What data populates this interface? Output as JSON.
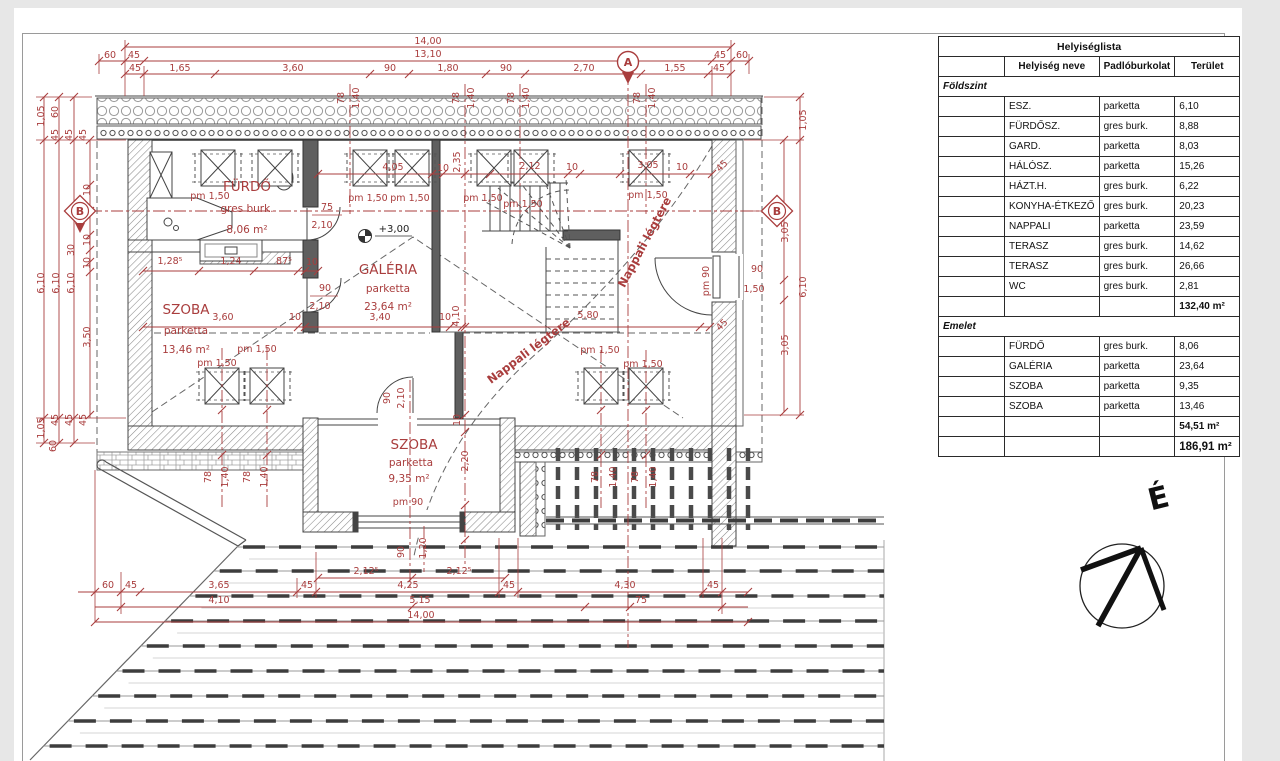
{
  "page": {
    "background": "#e7e7e7",
    "sheet_color": "#ffffff",
    "accent_red": "#a93d3d",
    "line_color": "#444444"
  },
  "plan": {
    "rooms": [
      {
        "name": "FÜRDŐ",
        "floor": "gres burk.",
        "area": "8,06 m²"
      },
      {
        "name": "GALÉRIA",
        "floor": "parketta",
        "area": "23,64 m²"
      },
      {
        "name": "SZOBA",
        "floor": "parketta",
        "area": "13,46 m²"
      },
      {
        "name": "SZOBA",
        "floor": "parketta",
        "area": "9,35 m²"
      }
    ],
    "section_markers": [
      "A",
      "B",
      "B"
    ],
    "level_marker": "+3,00",
    "north_label": "É",
    "labels": [
      {
        "t": "14,00",
        "x": 428,
        "y": 44
      },
      {
        "t": "60",
        "x": 110,
        "y": 58
      },
      {
        "t": "45",
        "x": 134,
        "y": 58
      },
      {
        "t": "13,10",
        "x": 428,
        "y": 57
      },
      {
        "t": "45",
        "x": 720,
        "y": 58
      },
      {
        "t": "60",
        "x": 742,
        "y": 58
      },
      {
        "t": "45",
        "x": 135,
        "y": 71
      },
      {
        "t": "1,65",
        "x": 180,
        "y": 71
      },
      {
        "t": "3,60",
        "x": 293,
        "y": 71
      },
      {
        "t": "90",
        "x": 390,
        "y": 71
      },
      {
        "t": "1,80",
        "x": 448,
        "y": 71
      },
      {
        "t": "90",
        "x": 506,
        "y": 71
      },
      {
        "t": "2,70",
        "x": 584,
        "y": 71
      },
      {
        "t": "1,55",
        "x": 675,
        "y": 71
      },
      {
        "t": "45",
        "x": 719,
        "y": 71
      },
      {
        "t": "78",
        "x": 344,
        "y": 98,
        "r": -90
      },
      {
        "t": "1,40",
        "x": 359,
        "y": 98,
        "r": -90
      },
      {
        "t": "78",
        "x": 459,
        "y": 98,
        "r": -90
      },
      {
        "t": "1,40",
        "x": 474,
        "y": 98,
        "r": -90
      },
      {
        "t": "78",
        "x": 514,
        "y": 98,
        "r": -90
      },
      {
        "t": "1,40",
        "x": 529,
        "y": 98,
        "r": -90
      },
      {
        "t": "78",
        "x": 640,
        "y": 98,
        "r": -90
      },
      {
        "t": "1,40",
        "x": 655,
        "y": 98,
        "r": -90
      },
      {
        "t": "1,05",
        "x": 44,
        "y": 116,
        "r": -90
      },
      {
        "t": "60",
        "x": 58,
        "y": 112,
        "r": -90
      },
      {
        "t": "45",
        "x": 58,
        "y": 135,
        "r": -90
      },
      {
        "t": "45",
        "x": 72,
        "y": 135,
        "r": -90
      },
      {
        "t": "45",
        "x": 86,
        "y": 135,
        "r": -90
      },
      {
        "t": "6,10",
        "x": 44,
        "y": 283,
        "r": -90
      },
      {
        "t": "6,10",
        "x": 59,
        "y": 283,
        "r": -90
      },
      {
        "t": "6,10",
        "x": 74,
        "y": 283,
        "r": -90
      },
      {
        "t": "10",
        "x": 90,
        "y": 190,
        "r": -90
      },
      {
        "t": "10",
        "x": 90,
        "y": 240,
        "r": -90
      },
      {
        "t": "30",
        "x": 74,
        "y": 250,
        "r": -90
      },
      {
        "t": "10",
        "x": 90,
        "y": 263,
        "r": -90
      },
      {
        "t": "3,50",
        "x": 90,
        "y": 337,
        "r": -90
      },
      {
        "t": "45",
        "x": 58,
        "y": 420,
        "r": -90
      },
      {
        "t": "45",
        "x": 72,
        "y": 420,
        "r": -90
      },
      {
        "t": "45",
        "x": 86,
        "y": 420,
        "r": -90
      },
      {
        "t": "1,05",
        "x": 44,
        "y": 428,
        "r": -90
      },
      {
        "t": "60",
        "x": 56,
        "y": 446,
        "r": -90
      },
      {
        "t": "1,05",
        "x": 806,
        "y": 120,
        "r": -90
      },
      {
        "t": "3,05",
        "x": 788,
        "y": 232,
        "r": -90
      },
      {
        "t": "6,10",
        "x": 806,
        "y": 287,
        "r": -90
      },
      {
        "t": "3,05",
        "x": 788,
        "y": 345,
        "r": -90
      },
      {
        "t": "45",
        "x": 724,
        "y": 168,
        "r": -45
      },
      {
        "t": "45",
        "x": 724,
        "y": 327,
        "r": -45
      },
      {
        "t": "pm 90",
        "x": 709,
        "y": 281,
        "r": -90
      },
      {
        "t": "90",
        "x": 757,
        "y": 272
      },
      {
        "t": "1,50",
        "x": 754,
        "y": 292
      },
      {
        "t": "2,12⁵",
        "x": 366,
        "y": 574
      },
      {
        "t": "2,12⁵",
        "x": 459,
        "y": 574
      },
      {
        "t": "60",
        "x": 108,
        "y": 588
      },
      {
        "t": "45",
        "x": 131,
        "y": 588
      },
      {
        "t": "3,65",
        "x": 219,
        "y": 588
      },
      {
        "t": "45",
        "x": 307,
        "y": 588
      },
      {
        "t": "4,25",
        "x": 408,
        "y": 588
      },
      {
        "t": "45",
        "x": 509,
        "y": 588
      },
      {
        "t": "4,30",
        "x": 625,
        "y": 588
      },
      {
        "t": "45",
        "x": 713,
        "y": 588
      },
      {
        "t": "4,10",
        "x": 219,
        "y": 603
      },
      {
        "t": "5,15",
        "x": 420,
        "y": 603
      },
      {
        "t": "75",
        "x": 641,
        "y": 603
      },
      {
        "t": "14,00",
        "x": 421,
        "y": 618
      },
      {
        "t": "90",
        "x": 404,
        "y": 552,
        "r": -90
      },
      {
        "t": "1,20",
        "x": 426,
        "y": 548,
        "r": -90
      },
      {
        "t": "78",
        "x": 211,
        "y": 477,
        "r": -90
      },
      {
        "t": "1,40",
        "x": 228,
        "y": 477,
        "r": -90
      },
      {
        "t": "78",
        "x": 250,
        "y": 477,
        "r": -90
      },
      {
        "t": "1,40",
        "x": 267,
        "y": 477,
        "r": -90
      },
      {
        "t": "78",
        "x": 598,
        "y": 477,
        "r": -90
      },
      {
        "t": "1,40",
        "x": 616,
        "y": 477,
        "r": -90
      },
      {
        "t": "78",
        "x": 638,
        "y": 477,
        "r": -90
      },
      {
        "t": "1,40",
        "x": 656,
        "y": 477,
        "r": -90
      },
      {
        "t": "4,05",
        "x": 393,
        "y": 170
      },
      {
        "t": "10",
        "x": 443,
        "y": 171
      },
      {
        "t": "2,12",
        "x": 530,
        "y": 169
      },
      {
        "t": "10",
        "x": 572,
        "y": 170
      },
      {
        "t": "3,05",
        "x": 648,
        "y": 168
      },
      {
        "t": "10",
        "x": 682,
        "y": 170
      },
      {
        "t": "2,35",
        "x": 460,
        "y": 162,
        "r": -90
      },
      {
        "t": "1,28⁵",
        "x": 170,
        "y": 264
      },
      {
        "t": "1,24",
        "x": 231,
        "y": 264
      },
      {
        "t": "87⁵",
        "x": 284,
        "y": 264
      },
      {
        "t": "10",
        "x": 312,
        "y": 265
      },
      {
        "t": "3,60",
        "x": 223,
        "y": 320
      },
      {
        "t": "10",
        "x": 295,
        "y": 320
      },
      {
        "t": "3,40",
        "x": 380,
        "y": 320
      },
      {
        "t": "10",
        "x": 445,
        "y": 320
      },
      {
        "t": "5,80",
        "x": 588,
        "y": 318
      },
      {
        "t": "4,10",
        "x": 459,
        "y": 316,
        "r": -90
      },
      {
        "t": "10",
        "x": 460,
        "y": 420,
        "r": -90
      },
      {
        "t": "2,20",
        "x": 468,
        "y": 461,
        "r": -90
      },
      {
        "t": "90",
        "x": 390,
        "y": 398,
        "r": -90
      },
      {
        "t": "2,10",
        "x": 404,
        "y": 398,
        "r": -90
      },
      {
        "t": "75",
        "x": 327,
        "y": 210
      },
      {
        "t": "2,10",
        "x": 322,
        "y": 228
      },
      {
        "t": "90",
        "x": 325,
        "y": 291
      },
      {
        "t": "2,10",
        "x": 320,
        "y": 309
      },
      {
        "t": "pm 1,50",
        "x": 210,
        "y": 199
      },
      {
        "t": "pm 1,50",
        "x": 368,
        "y": 201
      },
      {
        "t": "pm 1,50",
        "x": 410,
        "y": 201
      },
      {
        "t": "pm 1,50",
        "x": 483,
        "y": 201
      },
      {
        "t": "pm 1,50",
        "x": 523,
        "y": 207
      },
      {
        "t": "pm 1,50",
        "x": 648,
        "y": 198
      },
      {
        "t": "pm 1,50",
        "x": 257,
        "y": 352
      },
      {
        "t": "pm 1,50",
        "x": 217,
        "y": 366
      },
      {
        "t": "pm 1,50",
        "x": 600,
        "y": 353
      },
      {
        "t": "pm 1,50",
        "x": 643,
        "y": 367
      },
      {
        "t": "pm 90",
        "x": 408,
        "y": 505
      },
      {
        "t": "FÜRDŐ",
        "x": 247,
        "y": 191,
        "c": "room"
      },
      {
        "t": "gres burk.",
        "x": 247,
        "y": 212,
        "c": "sub"
      },
      {
        "t": "8,06 m²",
        "x": 247,
        "y": 233,
        "c": "sub"
      },
      {
        "t": "GALÉRIA",
        "x": 388,
        "y": 274,
        "c": "room"
      },
      {
        "t": "parketta",
        "x": 388,
        "y": 292,
        "c": "sub"
      },
      {
        "t": "23,64 m²",
        "x": 388,
        "y": 310,
        "c": "sub"
      },
      {
        "t": "SZOBA",
        "x": 186,
        "y": 314,
        "c": "room"
      },
      {
        "t": "parketta",
        "x": 186,
        "y": 334,
        "c": "sub"
      },
      {
        "t": "13,46 m²",
        "x": 186,
        "y": 353,
        "c": "sub"
      },
      {
        "t": "SZOBA",
        "x": 414,
        "y": 449,
        "c": "room"
      },
      {
        "t": "parketta",
        "x": 411,
        "y": 466,
        "c": "sub"
      },
      {
        "t": "9,35 m²",
        "x": 409,
        "y": 482,
        "c": "sub"
      },
      {
        "t": "Nappali légtere",
        "x": 648,
        "y": 244,
        "r": -62,
        "c": "ann"
      },
      {
        "t": "Nappali légtere",
        "x": 531,
        "y": 354,
        "r": -37,
        "c": "ann"
      },
      {
        "t": "+3,00",
        "x": 394,
        "y": 232,
        "c": "lvl"
      },
      {
        "t": "A",
        "x": 628,
        "y": 66,
        "c": "mk"
      },
      {
        "t": "B",
        "x": 80,
        "y": 215,
        "c": "mk"
      },
      {
        "t": "B",
        "x": 777,
        "y": 215,
        "c": "mk"
      },
      {
        "t": "É",
        "x": 1161,
        "y": 508,
        "r": -14,
        "c": "north"
      }
    ]
  },
  "room_table": {
    "title": "Helyiséglista",
    "headers": [
      "",
      "Helyiség neve",
      "Padlóburkolat",
      "Terület"
    ],
    "sections": [
      {
        "name": "Földszint",
        "rows": [
          [
            "ESZ.",
            "parketta",
            "6,10"
          ],
          [
            "FÜRDŐSZ.",
            "gres burk.",
            "8,88"
          ],
          [
            "GARD.",
            "parketta",
            "8,03"
          ],
          [
            "HÁLÓSZ.",
            "parketta",
            "15,26"
          ],
          [
            "HÁZT.H.",
            "gres burk.",
            "6,22"
          ],
          [
            "KONYHA-ÉTKEZŐ",
            "gres burk.",
            "20,23"
          ],
          [
            "NAPPALI",
            "parketta",
            "23,59"
          ],
          [
            "TERASZ",
            "gres burk.",
            "14,62"
          ],
          [
            "TERASZ",
            "gres burk.",
            "26,66"
          ],
          [
            "WC",
            "gres burk.",
            "2,81"
          ]
        ],
        "subtotal": "132,40 m²"
      },
      {
        "name": "Emelet",
        "rows": [
          [
            "FÜRDŐ",
            "gres burk.",
            "8,06"
          ],
          [
            "GALÉRIA",
            "parketta",
            "23,64"
          ],
          [
            "SZOBA",
            "parketta",
            "9,35"
          ],
          [
            "SZOBA",
            "parketta",
            "13,46"
          ]
        ],
        "subtotal": "54,51 m²"
      }
    ],
    "total": "186,91 m²"
  }
}
